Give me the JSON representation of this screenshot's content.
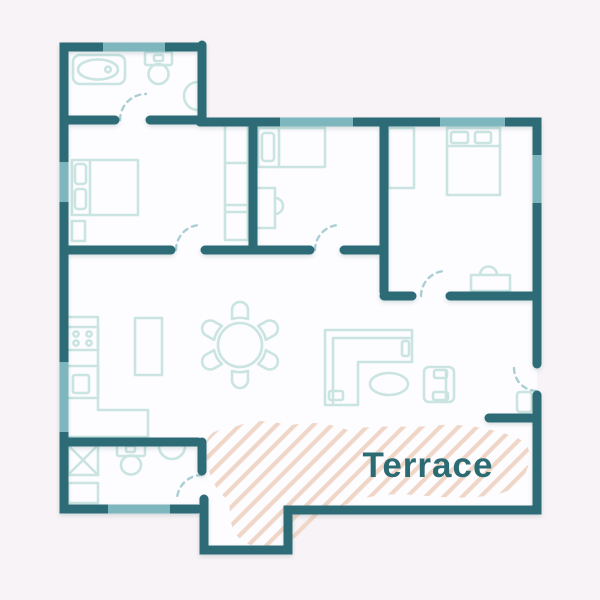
{
  "terrace": {
    "label": "Terrace"
  },
  "colors": {
    "background": "#f7f3f6",
    "floor": "#fdfcfe",
    "wall": "#2d6b76",
    "window": "#7db6bd",
    "furniture": "#c9e4e1",
    "door": "#a9cfd4",
    "hatch": "#f0d6c7",
    "label": "#2a6b74"
  },
  "plan": {
    "type": "apartment-floor-plan",
    "rooms": [
      {
        "name": "bathroom-top-left",
        "fixtures": [
          "bathtub",
          "toilet",
          "wall-sink"
        ],
        "windows": 1,
        "doors": 1
      },
      {
        "name": "bedroom-left",
        "fixtures": [
          "double-bed",
          "pillows-x2",
          "nightstand",
          "wardrobe"
        ],
        "windows": 1,
        "doors": 1
      },
      {
        "name": "bedroom-middle",
        "fixtures": [
          "single-bed",
          "pillow",
          "desk",
          "chair"
        ],
        "windows": 1,
        "doors": 1
      },
      {
        "name": "bedroom-right",
        "fixtures": [
          "double-bed",
          "pillows-x2",
          "closet",
          "desk",
          "chair"
        ],
        "windows": 2,
        "doors": 1
      },
      {
        "name": "kitchen-living-dining",
        "fixtures": [
          "kitchen-counter-L",
          "stove-4-burners",
          "kitchen-sink",
          "island",
          "dining-table-round",
          "dining-chairs-x6",
          "corner-sofa",
          "coffee-table-oval",
          "armchair"
        ],
        "windows": 1
      },
      {
        "name": "bathroom-bottom-left",
        "fixtures": [
          "washing-machine",
          "cabinet",
          "toilet",
          "wall-sink"
        ],
        "windows": 1,
        "doors": 1
      },
      {
        "name": "entry",
        "fixtures": [
          "doormat"
        ],
        "doors": 1
      },
      {
        "name": "terrace",
        "surface": "hatched"
      }
    ]
  }
}
